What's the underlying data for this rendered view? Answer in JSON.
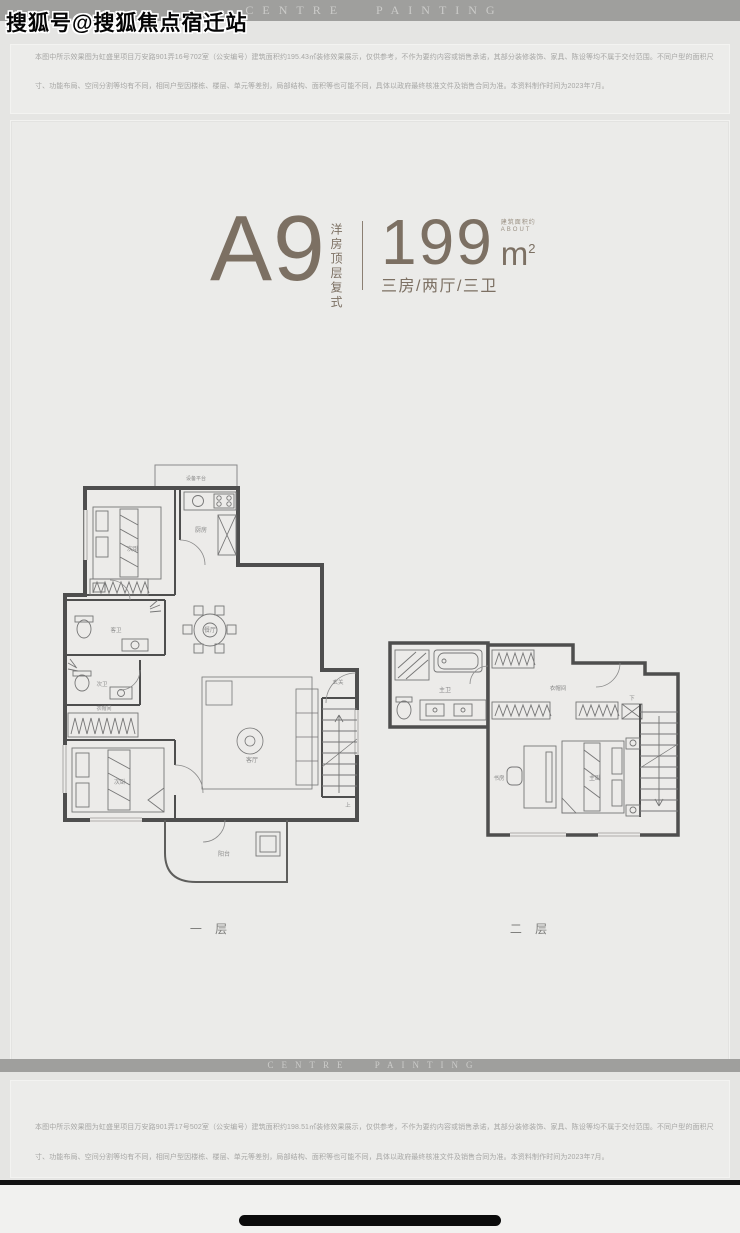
{
  "watermark": "搜狐号@搜狐焦点宿迁站",
  "header": {
    "brand": "CENTRE PAINTING"
  },
  "footer": {
    "brand": "CENTRE PAINTING"
  },
  "disclaimer_top": {
    "line1": "本图中所示效果图为虹盛里项目万安路901弄16号702室（公安编号）建筑面积约195.43㎡装修效果展示，仅供参考，不作为要约内容或销售承诺，其部分装修装饰、家具、陈设等均不属于交付范围。不同户型的面积尺",
    "line2": "寸、功能布局、空间分割等均有不同，相同户型因楼栋、楼层、单元等差别，局部结构、面积等也可能不同，具体以政府最终核准文件及销售合同为准。本资料制作时间为2023年7月。"
  },
  "disclaimer_bottom": {
    "line1": "本图中所示效果图为虹盛里项目万安路901弄17号502室（公安编号）建筑面积约198.51㎡装修效果展示，仅供参考，不作为要约内容或销售承诺，其部分装修装饰、家具、陈设等均不属于交付范围。不同户型的面积尺",
    "line2": "寸、功能布局、空间分割等均有不同，相同户型因楼栋、楼层、单元等差别，局部结构、面积等也可能不同，具体以政府最终核准文件及销售合同为准。本资料制作时间为2023年7月。"
  },
  "unit": {
    "name": "A9",
    "category": "洋房顶层复式",
    "area_value": "199",
    "area_unit": "m",
    "area_sup": "2",
    "area_about_cn": "建筑面积约",
    "area_about_en": "ABOUT",
    "layout": "三房/两厅/三卫"
  },
  "floor1": {
    "caption": "一 层",
    "rooms": {
      "equip": "设备平台",
      "bed2": "次卧",
      "kitchen": "厨房",
      "bath_guest": "客卫",
      "bath_second": "次卫",
      "dining": "餐厅",
      "closet": "衣帽间",
      "bed3": "次卧",
      "living": "客厅",
      "foyer": "玄关",
      "balcony": "阳台",
      "stairs_up": "上"
    }
  },
  "floor2": {
    "caption": "二 层",
    "rooms": {
      "bath_master": "主卫",
      "closet": "衣帽间",
      "study": "书房",
      "bed_master": "主卧",
      "stairs_down": "下"
    }
  },
  "colors": {
    "accent_brown": "#7c7063",
    "band_gray": "#9f9f9d",
    "wall_gray": "#4e4e4e",
    "page_bg": "#e8e8e6"
  }
}
